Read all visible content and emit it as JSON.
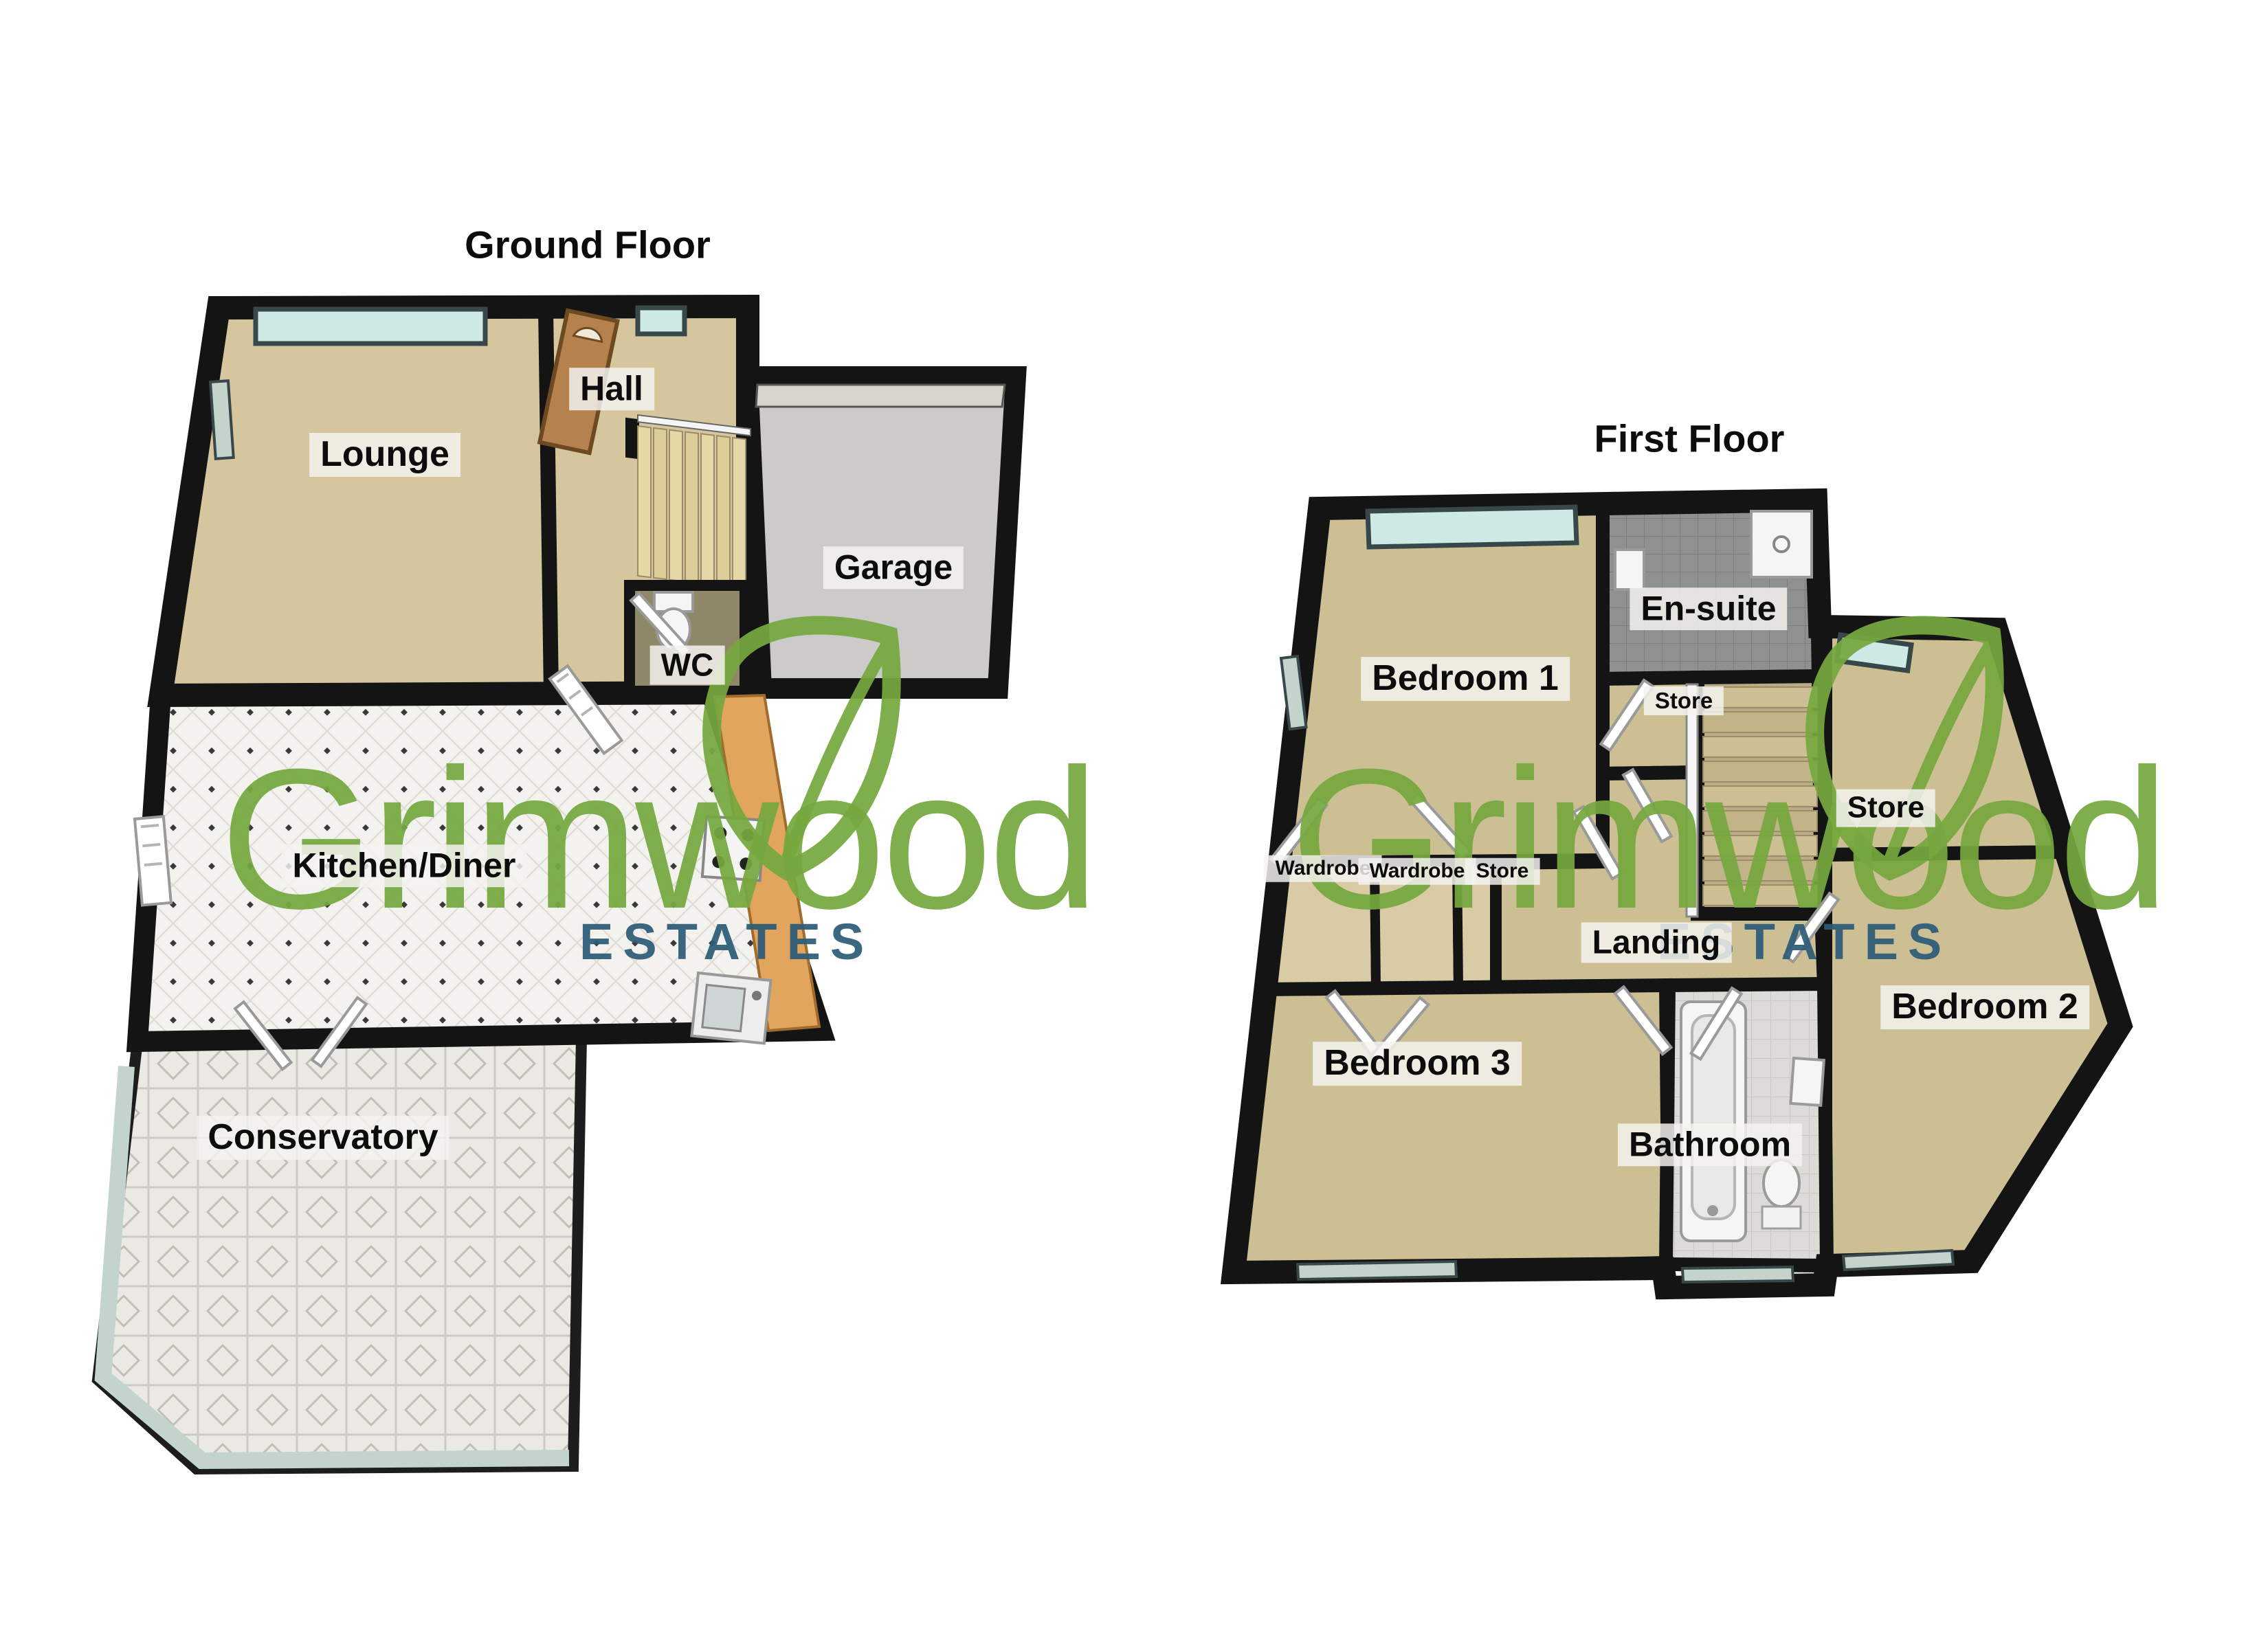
{
  "logo": {
    "brand": "Grimwood",
    "tagline": "ESTATES"
  },
  "floors": [
    {
      "title": "Ground Floor",
      "labels": [
        {
          "text": "Lounge"
        },
        {
          "text": "Hall"
        },
        {
          "text": "Garage"
        },
        {
          "text": "WC"
        },
        {
          "text": "Kitchen/Diner"
        },
        {
          "text": "Conservatory"
        }
      ]
    },
    {
      "title": "First Floor",
      "labels": [
        {
          "text": "Bedroom 1"
        },
        {
          "text": "En-suite"
        },
        {
          "text": "Store"
        },
        {
          "text": "Store"
        },
        {
          "text": "Wardrobe"
        },
        {
          "text": "Wardrobe"
        },
        {
          "text": "Store"
        },
        {
          "text": "Landing"
        },
        {
          "text": "Bedroom 2"
        },
        {
          "text": "Bedroom 3"
        },
        {
          "text": "Bathroom"
        }
      ]
    }
  ],
  "colors": {
    "wall": "#141414",
    "floor-beige": "#d5c69e",
    "floor-beige2": "#cdbf94",
    "floor-gray": "#cccbc9",
    "floor-kitchen": "#f3f2ee",
    "floor-tile": "#eae9e4",
    "floor-bath": "#dcdbd7",
    "floor-ensuite": "#8f9090",
    "floor-wc": "#8f8868",
    "glass": "#cdeae6",
    "glass2": "#c2d4cc",
    "door-wood": "#b5824e",
    "unit-orange": "#e2a55e",
    "stair": "#e2d3a2",
    "logo-green": "#76a83f",
    "logo-blue": "#2d5c78",
    "ink": "#0c0c0c",
    "page-bg": "#ffffff"
  }
}
